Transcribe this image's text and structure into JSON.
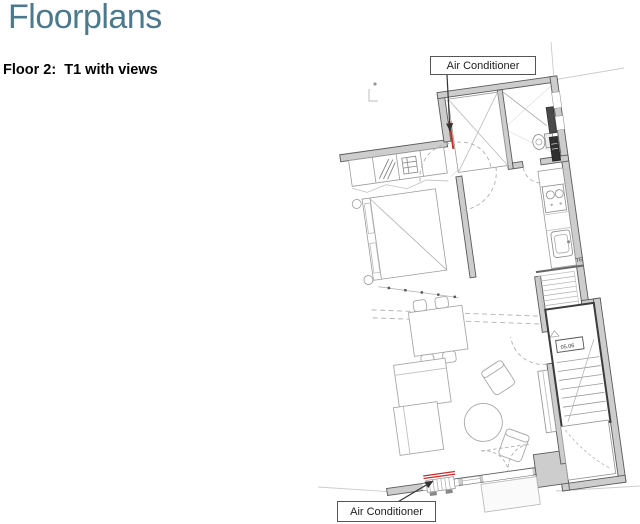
{
  "header": {
    "title": "Floorplans",
    "title_color": "#4c7a8c"
  },
  "section": {
    "floor_label": "Floor 2:  T1 with views"
  },
  "floorplan": {
    "callouts": {
      "top": "Air Conditioner",
      "bottom": "Air Conditioner"
    },
    "labels": {
      "stair_unit": "05.06",
      "kitchen_te": "TE"
    },
    "colors": {
      "wall_fill": "#cdcdcd",
      "wall_edge": "#5a5a5a",
      "furniture_line": "#a8a8a8",
      "stair_edge": "#3c3c3c",
      "ac_red": "#cc2a2a"
    }
  }
}
